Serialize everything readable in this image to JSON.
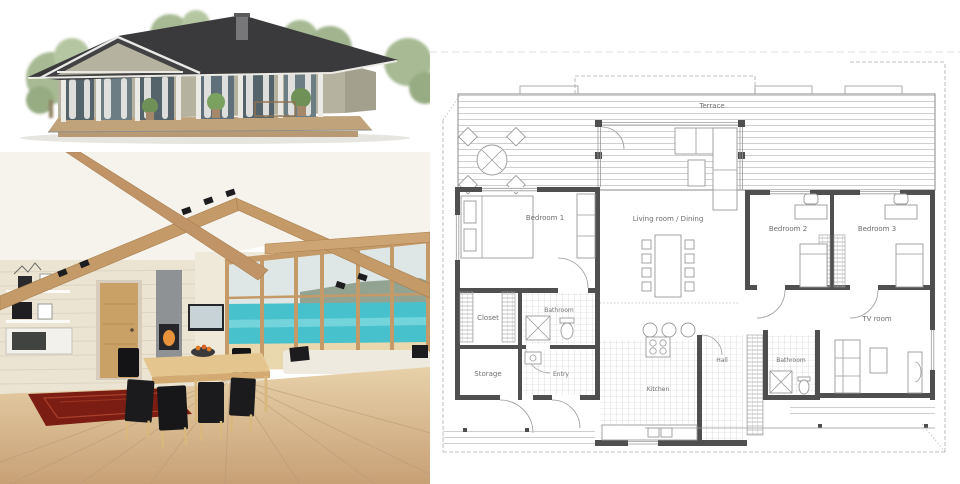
{
  "meta": {
    "kind": "house-design-collage"
  },
  "palette": {
    "plan_wall": "#4f4f4f",
    "plan_line": "#9a9a9a",
    "plan_tile": "#c9c9c9",
    "plan_label": "#6f6f6f",
    "roof": "#3a3a3c",
    "siding": "#b6b2a0",
    "siding_dark": "#a3a08e",
    "deck": "#c0a37b",
    "tree": "#a3b78e",
    "glass": "#55646b",
    "beam": "#c49a68",
    "wall_wood": "#ebe4d3",
    "floor_wood": "#dcc19d",
    "floor_wood_front": "#c8a076",
    "rug": "#7c1d13",
    "sea": "#47c1cc",
    "sand": "#e9d7ad",
    "sky": "#dfe7e6",
    "headland": "#93a392",
    "sofa": "#efeae0",
    "chair": "#1b1b1d",
    "table_wood": "#e5c58e",
    "door_wood": "#c9a167",
    "fireplace": "#8e9294"
  },
  "floor_plan": {
    "rooms": {
      "terrace": "Terrace",
      "bedroom1": "Bedroom 1",
      "living": "Living room / Dining",
      "bedroom2": "Bedroom 2",
      "bedroom3": "Bedroom 3",
      "closet": "Closet",
      "bathroom": "Bathroom",
      "storage": "Storage",
      "entry": "Entry",
      "kitchen": "Kitchen",
      "hall": "Hall",
      "bathroom2": "Bathroom",
      "tv_room": "TV room"
    }
  },
  "photos": {
    "exterior_alt": "Single-storey house with dark hip roof, covered wooden terrace and glass walls",
    "interior_alt": "Open-plan living and dining room with exposed wooden beams, fireplace and sea view"
  }
}
